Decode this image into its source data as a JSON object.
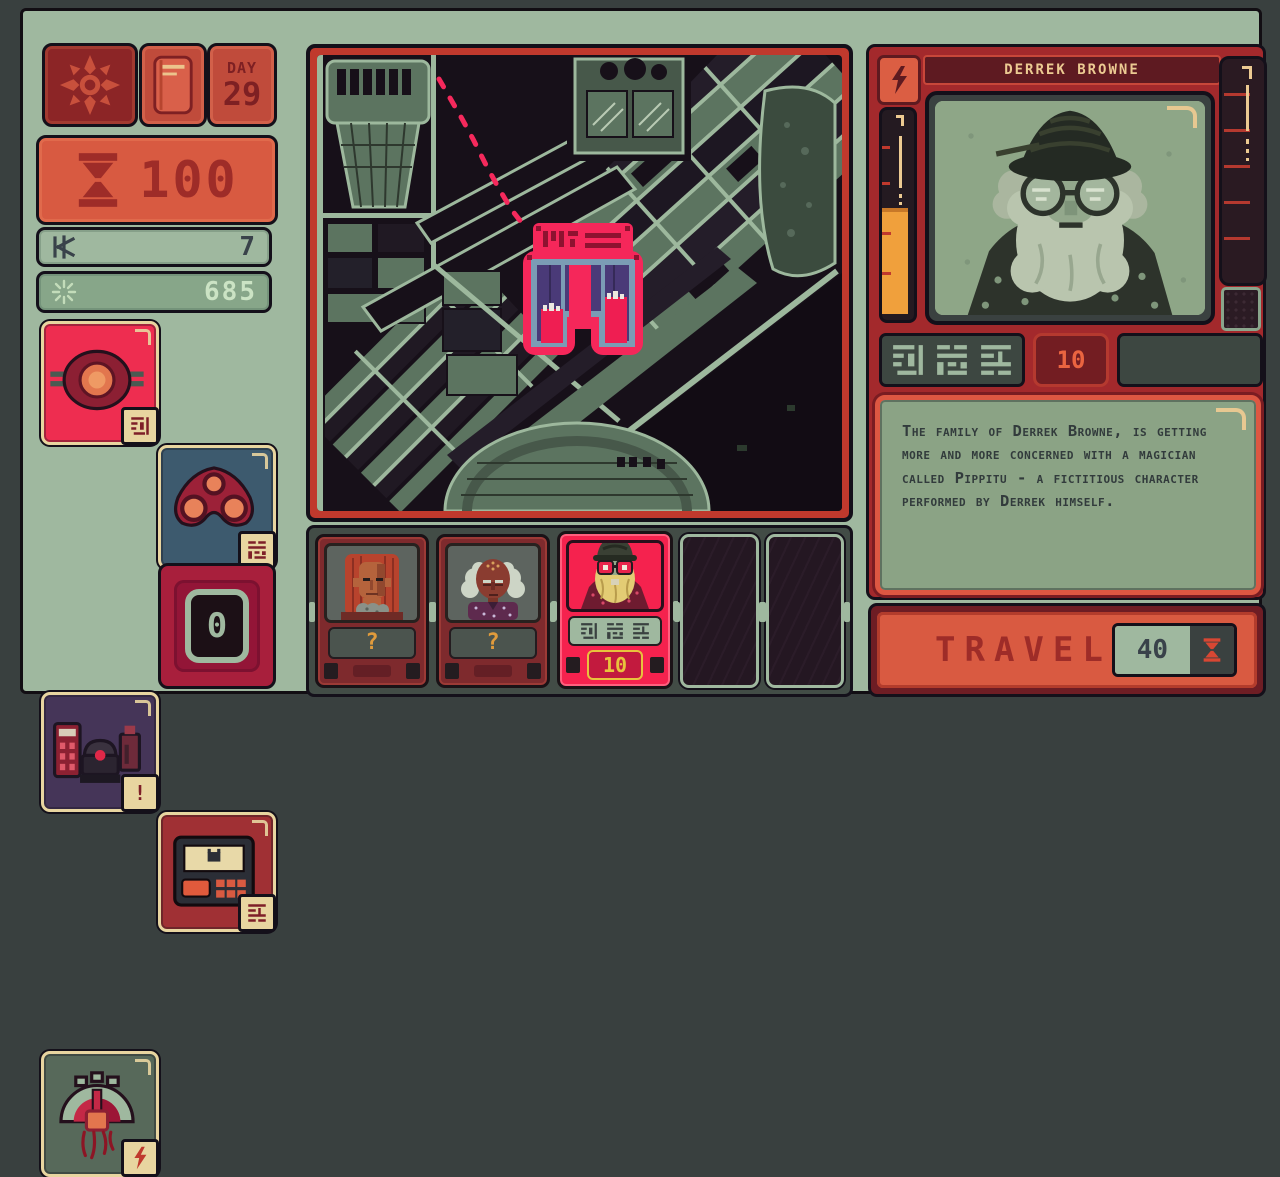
{
  "left_hud": {
    "day_label": "DAY",
    "day_value": "29",
    "time_units": "100",
    "credits": "7",
    "psycho_points": "685",
    "alert_badge": "!",
    "device_count": "0"
  },
  "queue": {
    "cards": [
      {
        "state": "unidentified",
        "label": "?"
      },
      {
        "state": "unidentified",
        "label": "?"
      },
      {
        "state": "selected",
        "price": "10"
      },
      {
        "state": "empty"
      },
      {
        "state": "empty"
      }
    ]
  },
  "patient": {
    "name": "DERREK BROWNE",
    "price": "10",
    "description": "The family of Derrek Browne, is getting more and more concerned with a magician called Pippitu - a fictitious character performed by Derrek himself."
  },
  "travel": {
    "label": "TRAVEL",
    "cost": "40"
  },
  "icons": {
    "compass": "compass-rose",
    "book": "log-book",
    "time": "hourglass",
    "credits": "credit-star",
    "psycho": "spark",
    "energy": "lightning-bolt",
    "script": "alien-script-glyphs",
    "map_marker": "target-building",
    "route": "dashed-route"
  },
  "colors": {
    "console_green": "#9fb89f",
    "panel_red": "#a3292c",
    "alert_orange": "#d95a41",
    "highlight_pink": "#f5275a",
    "cream": "#ecca92",
    "meter_orange": "#f0a03c",
    "map_street": "#9db89d",
    "map_dark": "#171019"
  }
}
